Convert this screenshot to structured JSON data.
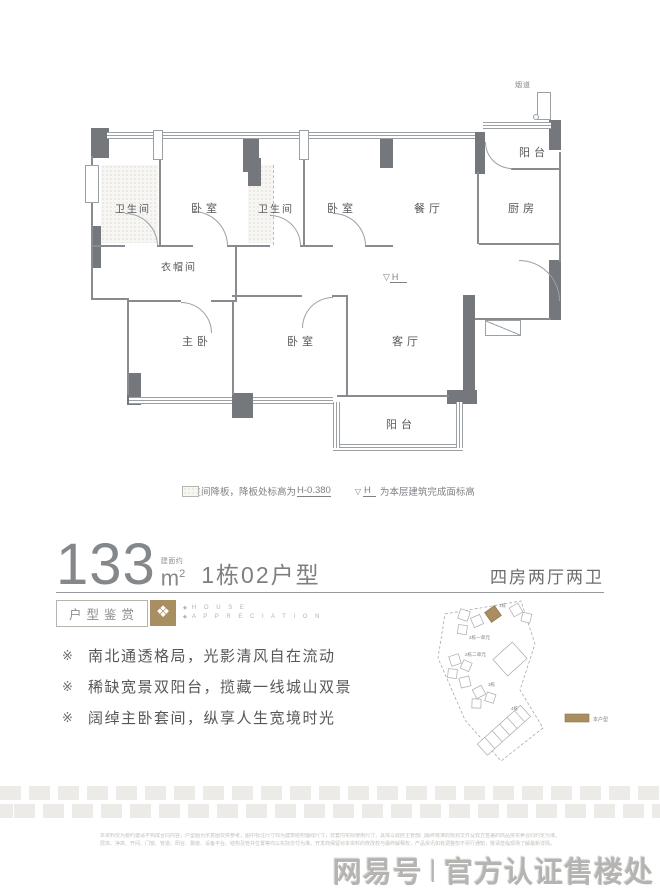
{
  "floor_plan": {
    "rooms": [
      {
        "label": "卫生间"
      },
      {
        "label": "卧室"
      },
      {
        "label": "卫生间"
      },
      {
        "label": "卧室"
      },
      {
        "label": "餐厅"
      },
      {
        "label": "厨房"
      },
      {
        "label": "阳台"
      },
      {
        "label": "衣帽间"
      },
      {
        "label": "主卧"
      },
      {
        "label": "卧室"
      },
      {
        "label": "客厅"
      },
      {
        "label": "阳台"
      }
    ],
    "flue_label": "烟道",
    "level_glyph": "▽",
    "level_letter": "H",
    "legend": {
      "note1_text": "卫生间降板，降板处标高为",
      "note1_value": "H-0.380",
      "note2_glyph": "▽",
      "note2_letter": "H",
      "note2_text": "为本层建筑完成面标高"
    }
  },
  "title": {
    "area": "133",
    "area_note": "建面约",
    "unit_base": "m",
    "unit_exp": "2",
    "plan_name": "1栋02户型",
    "layout_desc": "四房两厅两卫"
  },
  "section": {
    "title": "户型鉴赏",
    "icon_glyph": "❖",
    "en_marker": "◆",
    "en_word1": "H O U S E",
    "en_word2": "A P P R E C I A T I O N"
  },
  "features": [
    {
      "marker": "※",
      "text": "南北通透格局，光影清风自在流动"
    },
    {
      "marker": "※",
      "text": "稀缺宽景双阳台，揽藏一线城山双景"
    },
    {
      "marker": "※",
      "text": "阔绰主卧套间，纵享人生宽境时光"
    }
  ],
  "sitemap": {
    "building_labels": [
      "1栋",
      "2栋一单元",
      "2栋二单元",
      "3栋",
      "4栋"
    ],
    "legend_label": "本户型"
  },
  "footer": {
    "disclaimer_line1": "本资料仅为要约邀请不构成合同内容，户型图为示意图仅供参考，图中标注尺寸均为建筑结构轴线尺寸，非套内实际使用尺寸，具体以政府主管部门最终核准的规划文件及双方签署的商品房买卖合同约定为准。部分家具、洁具、饰品、绿植、电器等仅为装饰示意，不属于交付标准。",
    "disclaimer_line2": "层高、净高、开间、门窗、管道、阳台、飘窗、设备平台、结构及管井位置等均以实际交付为准。开发商保留对本资料的修改权与最终解释权，产品资讯如有调整恕不另行通知，敬请莅临现场了解最新详情。",
    "watermark_name": "网易号",
    "watermark_divider": "|",
    "watermark_text": "官方认证售楼处"
  },
  "colors": {
    "wall": "#74777b",
    "line": "#9aa0a4",
    "accent": "#a98e62",
    "text": "#55585c"
  }
}
